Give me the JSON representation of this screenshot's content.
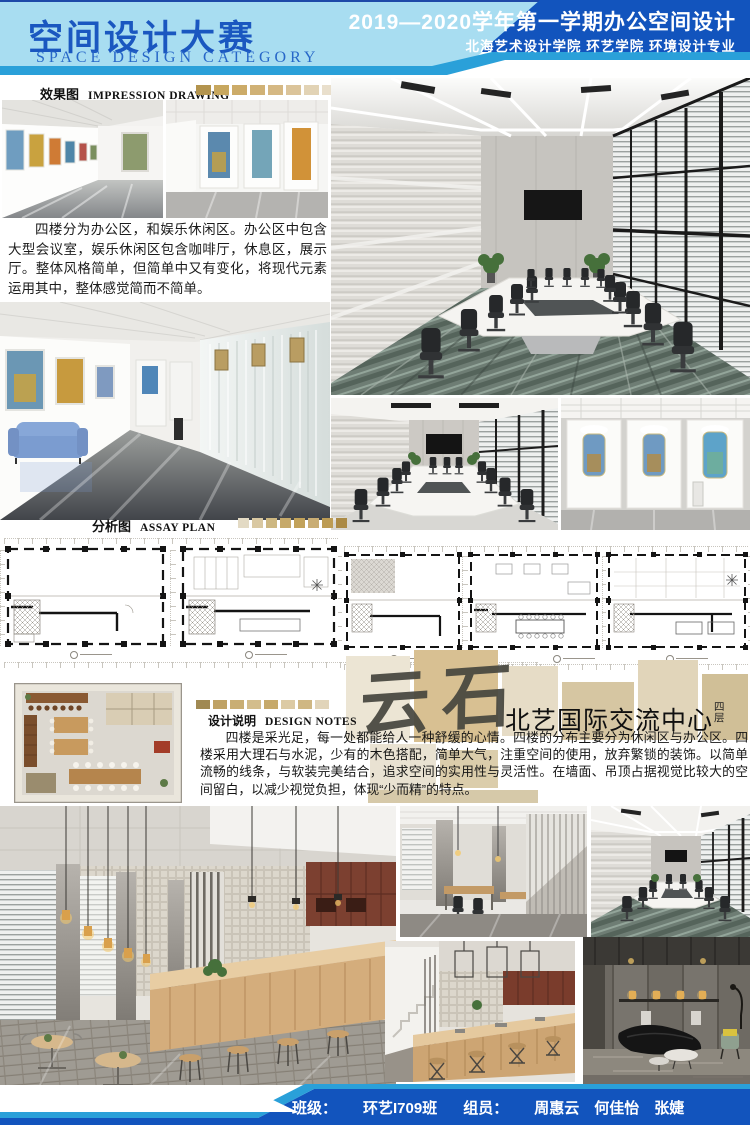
{
  "header": {
    "title_cn": "空间设计大赛",
    "title_en": "SPACE DESIGN CATEGORY",
    "course_title": "2019—2020学年第一学期办公空间设计",
    "school_line": "北海艺术设计学院  环艺学院  环境设计专业"
  },
  "sections": {
    "impression": {
      "label_cn": "效果图",
      "label_en": "IMPRESSION DRAWING"
    },
    "assay": {
      "label_cn": "分析图",
      "label_en": "ASSAY PLAN"
    },
    "design_notes": {
      "label_cn": "设计说明",
      "label_en": "DESIGN NOTES"
    }
  },
  "intro": {
    "text": "四楼分为办公区，和娱乐休闲区。办公区中包含大型会议室，娱乐休闲区包含咖啡厅，休息区，展示厅。整体风格简单，但简单中又有变化，将现代元素运用其中，整体感觉简而不简单。"
  },
  "project": {
    "watermark": "云石",
    "name": "北艺国际交流中心",
    "floor": "四层"
  },
  "design_notes": {
    "text": "四楼是采光足，每一处都能给人一种舒缓的心情。四楼的分布主要分为休闲区与办公区。四楼采用大理石与水泥，少有的木色搭配，简单大气，注重空间的使用，放弃繁锁的装饰。以简单流畅的线条，与软装完美结合，追求空间的实用性与灵活性。在墙面、吊顶占据视觉比较大的空间留白，以减少视觉负担，体现“少而精”的特点。"
  },
  "footer": {
    "class_label": "班级：",
    "class_value": "环艺I709班",
    "team_label": "组员：",
    "members": "周惠云　何佳怡　张婕"
  },
  "colors": {
    "accent_navy": "#1254bd",
    "accent_cyan": "#2aa0d9",
    "header_light_blue": "#a8ddf1",
    "title_blue": "#1a57c0",
    "swatches": {
      "impression": [
        "#b3944e",
        "#c7a75f",
        "#ccab68",
        "#d0b175",
        "#d5b883",
        "#dbc49a",
        "#e2d3b5",
        "#e9dfcc"
      ],
      "assay": [
        "#e3dac4",
        "#d9c8a2",
        "#cdb781",
        "#c6a96a",
        "#c2a25a",
        "#c9ad74",
        "#bd9c54",
        "#ab8a45"
      ],
      "design_notes": [
        "#a08953",
        "#bfa265",
        "#c9ae74",
        "#d3bd8c",
        "#c6a96a",
        "#dccaa4",
        "#cfb783",
        "#e1d4b9"
      ]
    }
  }
}
